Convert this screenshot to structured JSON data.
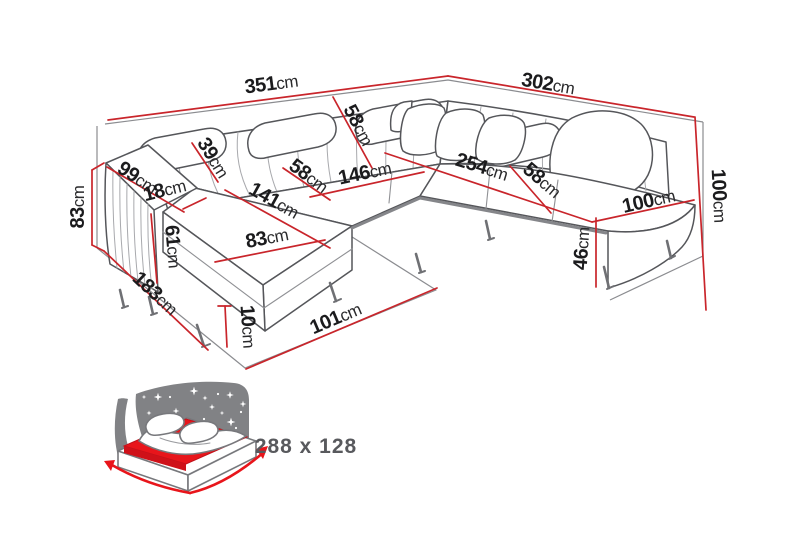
{
  "diagram": {
    "type": "furniture-dimension-diagram",
    "subject": "U-shaped corner sofa bed with headrests, corner pillows and chaise ends",
    "unit": "cm",
    "colors": {
      "dimension_line": "#c9252b",
      "sofa_outline": "#55565a",
      "room_outline": "#8b8c90",
      "label_text": "#1b1b1d",
      "bed_accent_red": "#e8151b",
      "icon_panel_gray": "#818285",
      "bed_size_text": "#58595d"
    },
    "dims": {
      "back_left": {
        "v": "351",
        "u": "cm"
      },
      "back_right": {
        "v": "302",
        "u": "cm"
      },
      "corner_back": {
        "v": "58",
        "u": "cm"
      },
      "headrest": {
        "v": "39",
        "u": "cm"
      },
      "armrest_depth": {
        "v": "99",
        "u": "cm"
      },
      "armrest_width": {
        "v": "18",
        "u": "cm"
      },
      "armrest_side": {
        "v": "61",
        "u": "cm"
      },
      "height_left": {
        "v": "83",
        "u": "cm"
      },
      "depth_left": {
        "v": "183",
        "u": "cm"
      },
      "chaise_length": {
        "v": "141",
        "u": "cm"
      },
      "chaise_width": {
        "v": "83",
        "u": "cm"
      },
      "seat_depth_left": {
        "v": "58",
        "u": "cm"
      },
      "inner_width": {
        "v": "146",
        "u": "cm"
      },
      "seat_width_right": {
        "v": "254",
        "u": "cm"
      },
      "seat_depth_right": {
        "v": "58",
        "u": "cm"
      },
      "end_width_right": {
        "v": "100",
        "u": "cm"
      },
      "seat_height": {
        "v": "46",
        "u": "cm"
      },
      "height_right": {
        "v": "100",
        "u": "cm"
      },
      "leg_height": {
        "v": "10",
        "u": "cm"
      },
      "front_width": {
        "v": "101",
        "u": "cm"
      }
    },
    "sleeping_area": {
      "label": "288 x 128"
    }
  }
}
